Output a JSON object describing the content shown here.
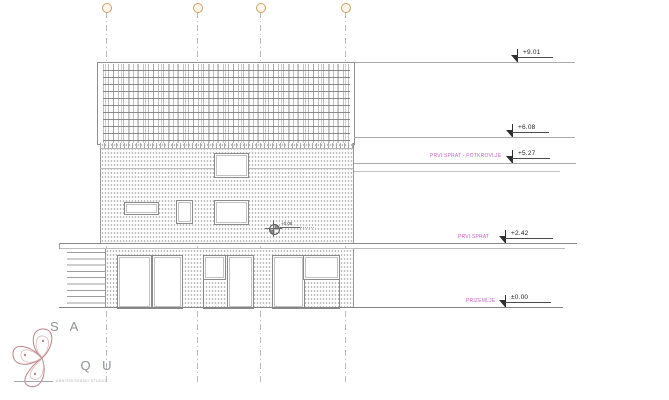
{
  "sheet": {
    "type": "architectural elevation drawing",
    "levels": [
      {
        "value": "+9.01",
        "label": ""
      },
      {
        "value": "+6.08",
        "label": ""
      },
      {
        "value": "+5.27",
        "label": "PRVI SPRAT - POTKROVLJE"
      },
      {
        "value": "+2.42",
        "label": "PRVI SPRAT"
      },
      {
        "value": "±0.00",
        "label": "PRIZEMLJE"
      }
    ],
    "spot_level": "+0.08",
    "colors": {
      "level_label_pink": "#cc5fcc",
      "grid_bubble_stroke": "#d2a063",
      "drawing_lines": "#8f8f8f",
      "logo_rose": "#bd8589"
    }
  },
  "logo": {
    "line1": "S A",
    "line2": "Q U",
    "line3": "R A",
    "tagline": "ARHITEKTONSKI STUDIO"
  }
}
